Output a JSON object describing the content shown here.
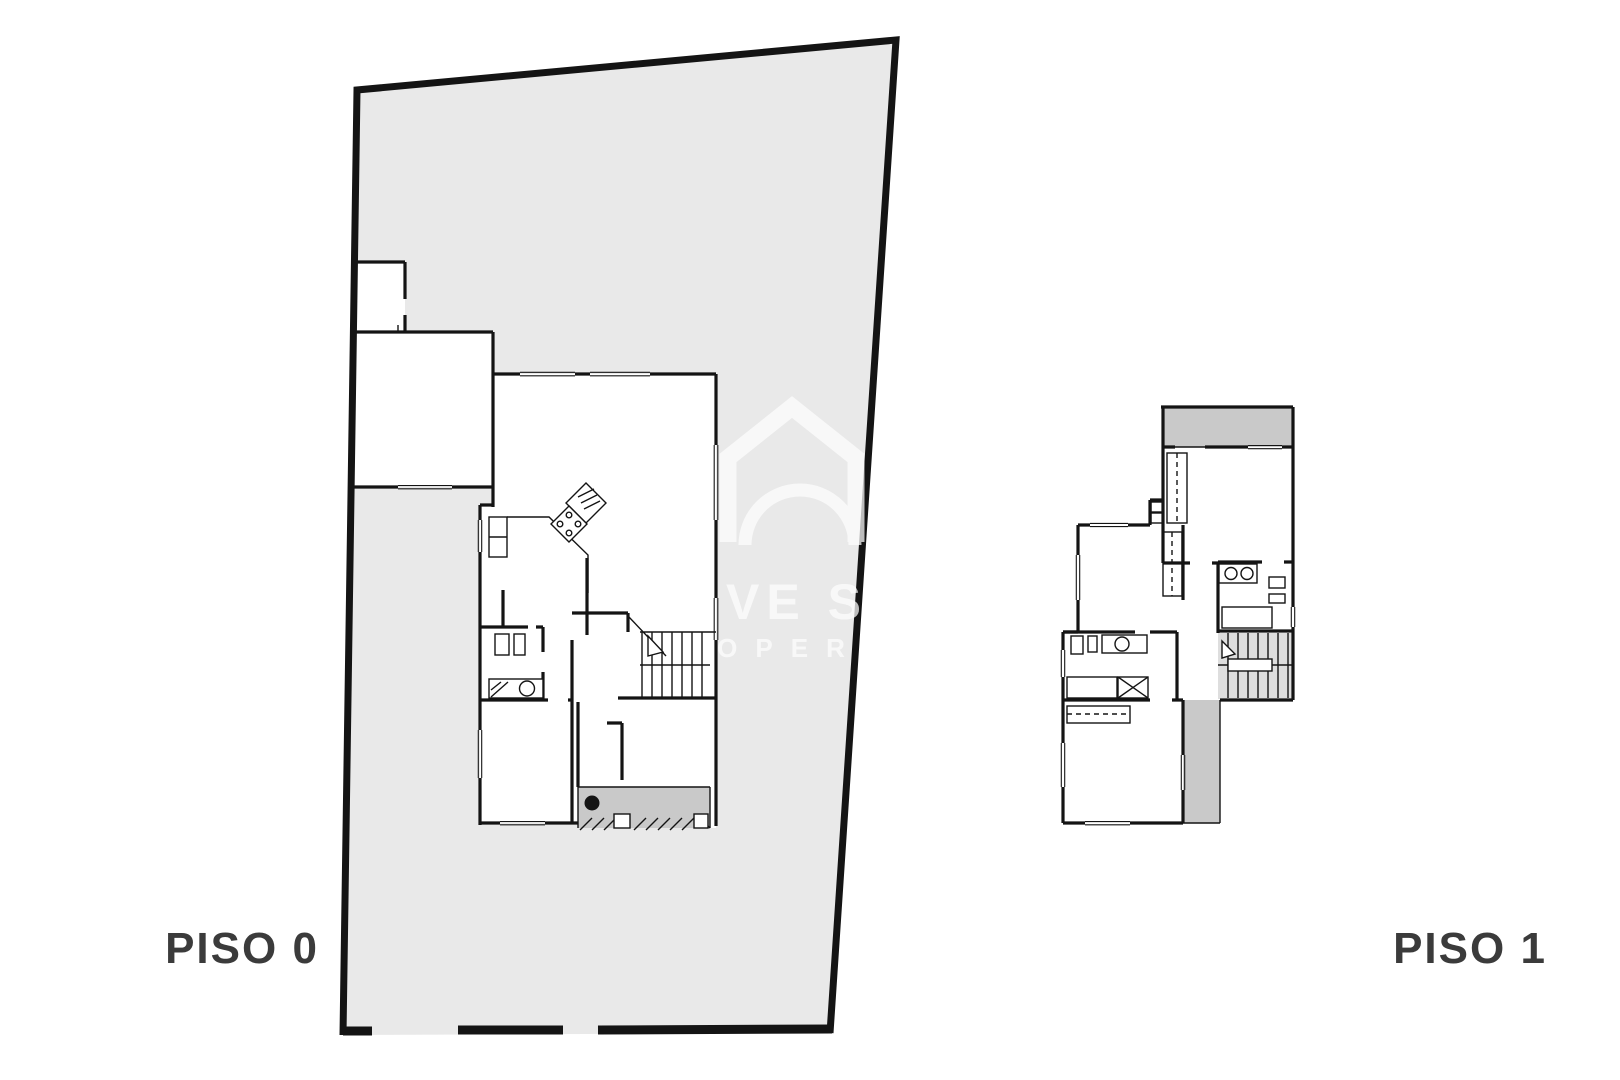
{
  "colors": {
    "background": "#ffffff",
    "plot": "#e9e9e9",
    "wall": "#141414",
    "terrace": "#c9c9c9",
    "stairs": "#dedede",
    "label": "#3b3b3b",
    "watermark": "#ffffff"
  },
  "labels": {
    "piso0": "PISO 0",
    "piso1": "PISO 1"
  },
  "watermark": {
    "line1": "VE S",
    "line2": "OPER"
  }
}
